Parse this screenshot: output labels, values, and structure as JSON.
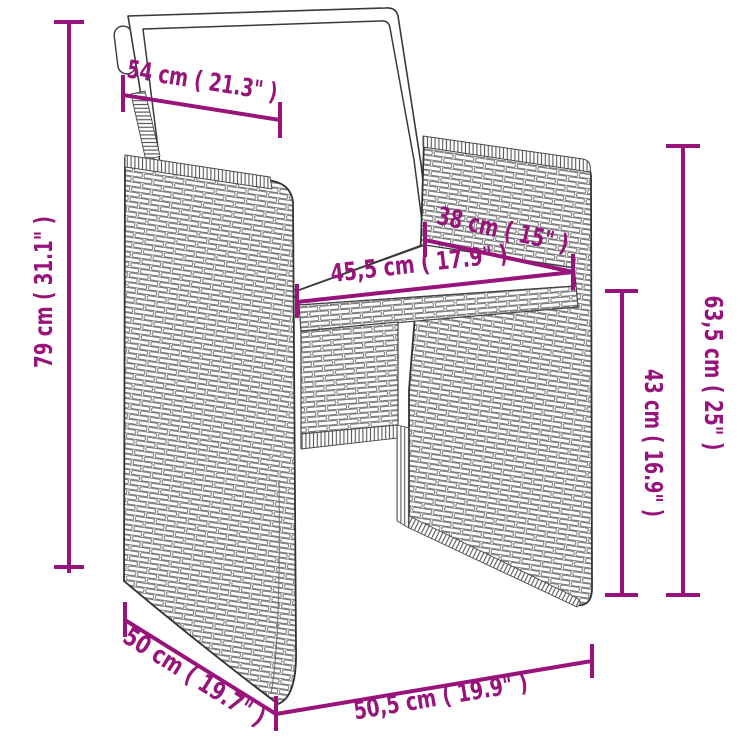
{
  "accent_color": "#98137A",
  "line_art_color": "#3a3a3a",
  "weave_line_color": "#6f6f6f",
  "background_color": "#ffffff",
  "diagram": {
    "type": "product-dimension-diagram",
    "subject": "poly rattan garden armchair with white cushions",
    "measurements": {
      "backrest_width": {
        "cm": "54",
        "inches": "21.3",
        "label": "54 cm ( 21.3\" )"
      },
      "overall_height": {
        "cm": "79",
        "inches": "31.1",
        "label": "79 cm ( 31.1\" )"
      },
      "seat_depth": {
        "cm": "38",
        "inches": "15",
        "label": "38 cm ( 15\" )"
      },
      "seat_width": {
        "cm": "45,5",
        "inches": "17.9",
        "label": "45,5 cm ( 17.9\" )"
      },
      "armrest_height": {
        "cm": "63,5",
        "inches": "25",
        "label": "63,5 cm ( 25\" )"
      },
      "seat_height": {
        "cm": "43",
        "inches": "16.9",
        "label": "43 cm ( 16.9\" )"
      },
      "base_depth": {
        "cm": "50",
        "inches": "19.7",
        "label": "50 cm ( 19.7\" )"
      },
      "base_width": {
        "cm": "50,5",
        "inches": "19.9",
        "label": "50,5 cm ( 19.9\" )"
      }
    }
  }
}
